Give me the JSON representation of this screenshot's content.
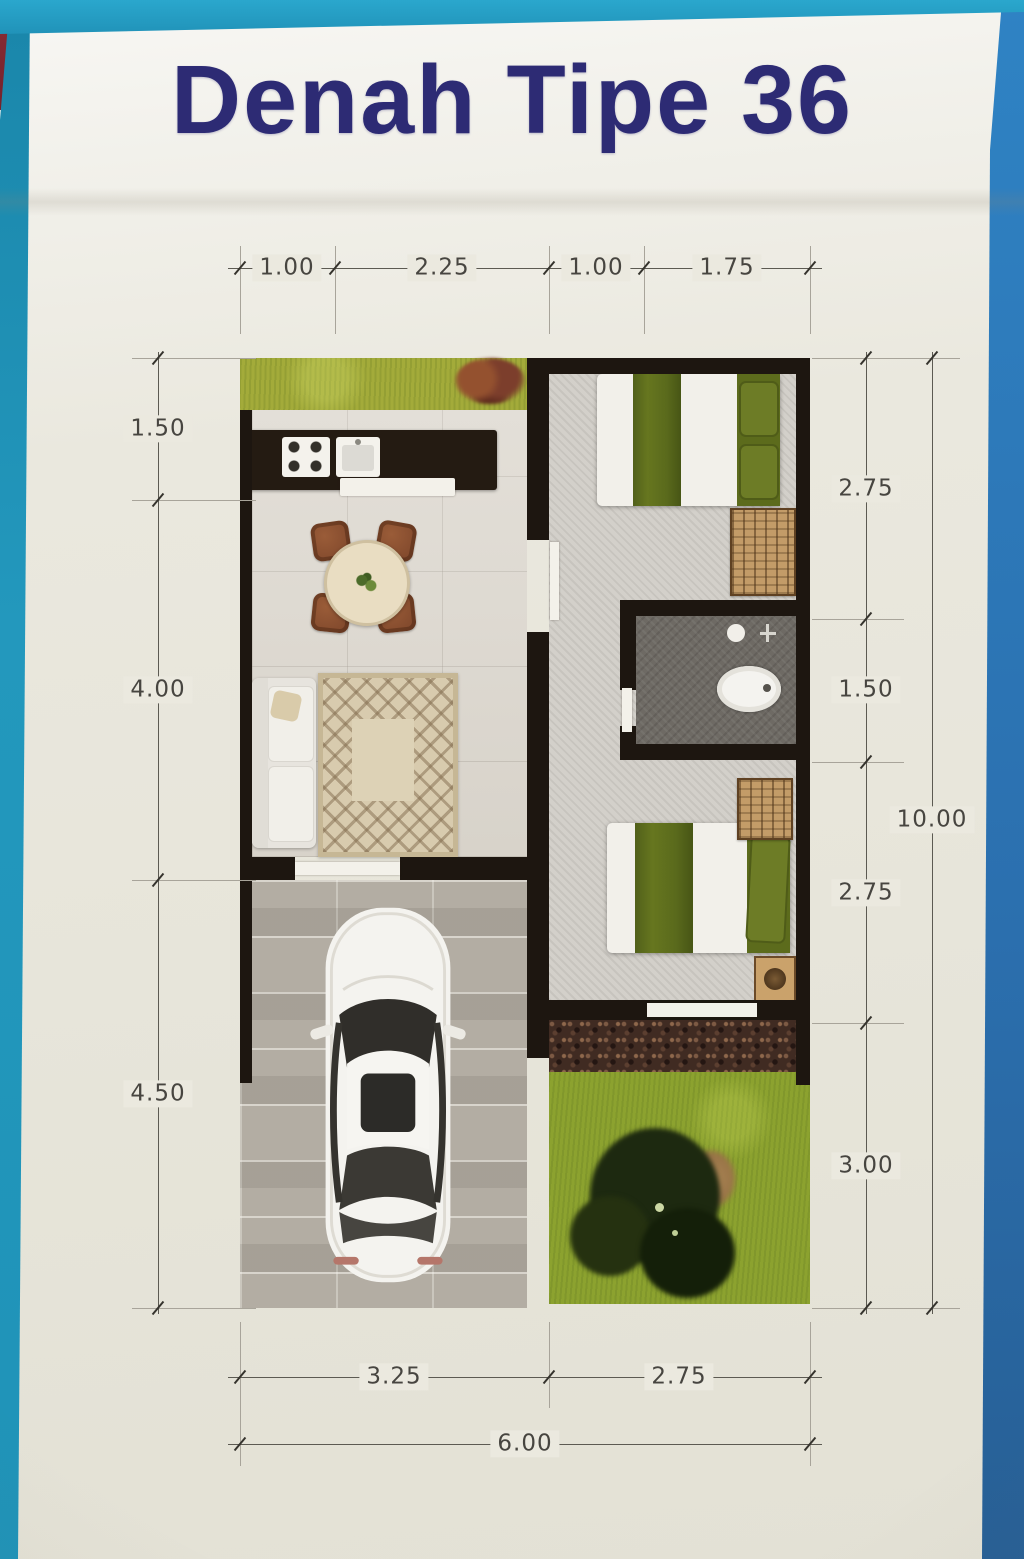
{
  "title": "Denah Tipe 36",
  "dims": {
    "top": [
      "1.00",
      "2.25",
      "1.00",
      "1.75"
    ],
    "left": [
      "1.50",
      "4.00",
      "4.50"
    ],
    "right": [
      "2.75",
      "1.50",
      "2.75",
      "3.00"
    ],
    "right_total": "10.00",
    "bottom": [
      "3.25",
      "2.75"
    ],
    "bottom_total": "6.00"
  },
  "colors": {
    "title_navy": "#2d2b74",
    "edge_cyan": "#2aa7cd",
    "edge_blue": "#2b6fae",
    "edge_red": "#8c2d36",
    "paper": "#eae8de",
    "wall_black": "#1d1610",
    "grass_green": "#8ca22f",
    "blanket_olive": "#5e6e1d",
    "wood_brown": "#c39c68",
    "chair_rust": "#8c5132"
  }
}
